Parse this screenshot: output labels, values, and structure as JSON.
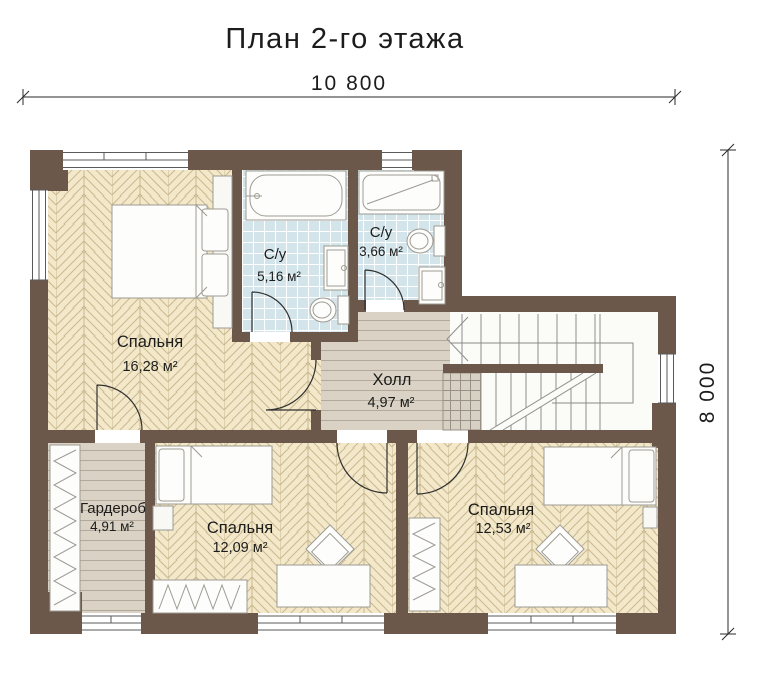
{
  "title": "План 2-го этажа",
  "dimensions": {
    "width_label": "10 800",
    "height_label": "8 000"
  },
  "rooms": [
    {
      "key": "bedroom-1",
      "name": "Спальня",
      "area": "16,28 м²"
    },
    {
      "key": "bathroom-1",
      "name": "С/у",
      "area": "5,16 м²"
    },
    {
      "key": "bathroom-2",
      "name": "С/у",
      "area": "3,66 м²"
    },
    {
      "key": "hall",
      "name": "Холл",
      "area": "4,97 м²"
    },
    {
      "key": "wardrobe",
      "name": "Гардероб",
      "area": "4,91 м²"
    },
    {
      "key": "bedroom-2",
      "name": "Спальня",
      "area": "12,09 м²"
    },
    {
      "key": "bedroom-3",
      "name": "Спальня",
      "area": "12,53 м²"
    }
  ],
  "colors": {
    "wall": "#6c574b",
    "floor": "#f3e8c9",
    "floor_line": "#c9b88f",
    "plank": "#dad3c5",
    "plank_line": "#b3a99b",
    "tile": "#d3e5ea",
    "tile_line": "#ffffff",
    "grid": "#d7d1c4",
    "grid_line": "#9a9085",
    "stair_bg": "#fbfbf8",
    "background": "#ffffff"
  }
}
